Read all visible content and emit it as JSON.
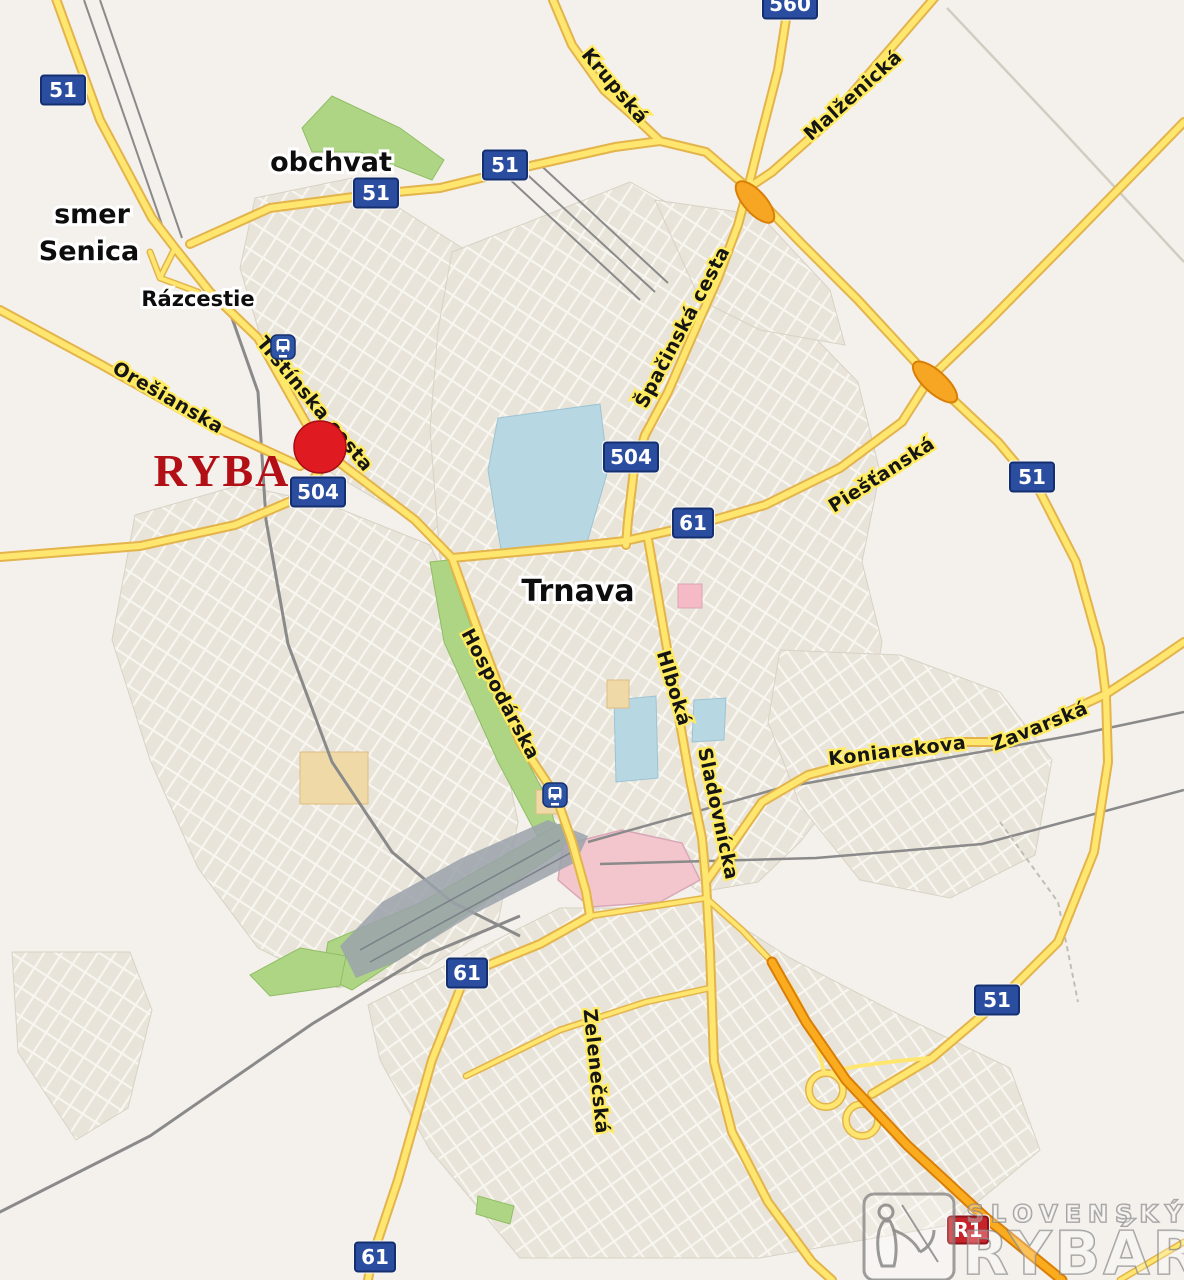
{
  "map": {
    "city_label": "Trnava",
    "place_labels": {
      "smer_line1": "smer",
      "smer_line2": "Senica",
      "obchvat": "obchvat",
      "razcestie": "Rázcestie"
    },
    "marker": {
      "label": "RYBA"
    },
    "road_labels": {
      "krupska": "Krupská",
      "malzenicka": "Malženická",
      "spacinska": "Špačinská cesta",
      "oresianska": "Orešianska",
      "trstinska": "Trstínska cesta",
      "piestanska": "Piešťanská",
      "hospodarska": "Hospodárska",
      "hlboka": "Hlboká",
      "sladovnicka": "Sladovnícka",
      "koniarekova": "Koniarekova",
      "zavarska": "Zavarská",
      "zelenecska": "Zelenečská"
    },
    "route_shields": {
      "r51": "51",
      "r61": "61",
      "r504": "504",
      "r560": "560",
      "r1": "R1"
    },
    "watermark": {
      "line1": "SLOVENSKÝ",
      "line2": "RYBÁR"
    },
    "colors": {
      "background": "#F4F1EC",
      "urban": "#E9E4D9",
      "road_major": "#FFE66E",
      "road_casing": "#E3B44C",
      "highway_orange": "#FBAB1E",
      "shield_blue": "#2B4DA0",
      "shield_red": "#C8232A",
      "marker_red": "#DF1B21",
      "ryba_text": "#B30F16",
      "water": "#B7D8E2",
      "green": "#AED584",
      "pink_area": "#F3C6CD",
      "railway_gray": "#8A8A8A"
    }
  }
}
